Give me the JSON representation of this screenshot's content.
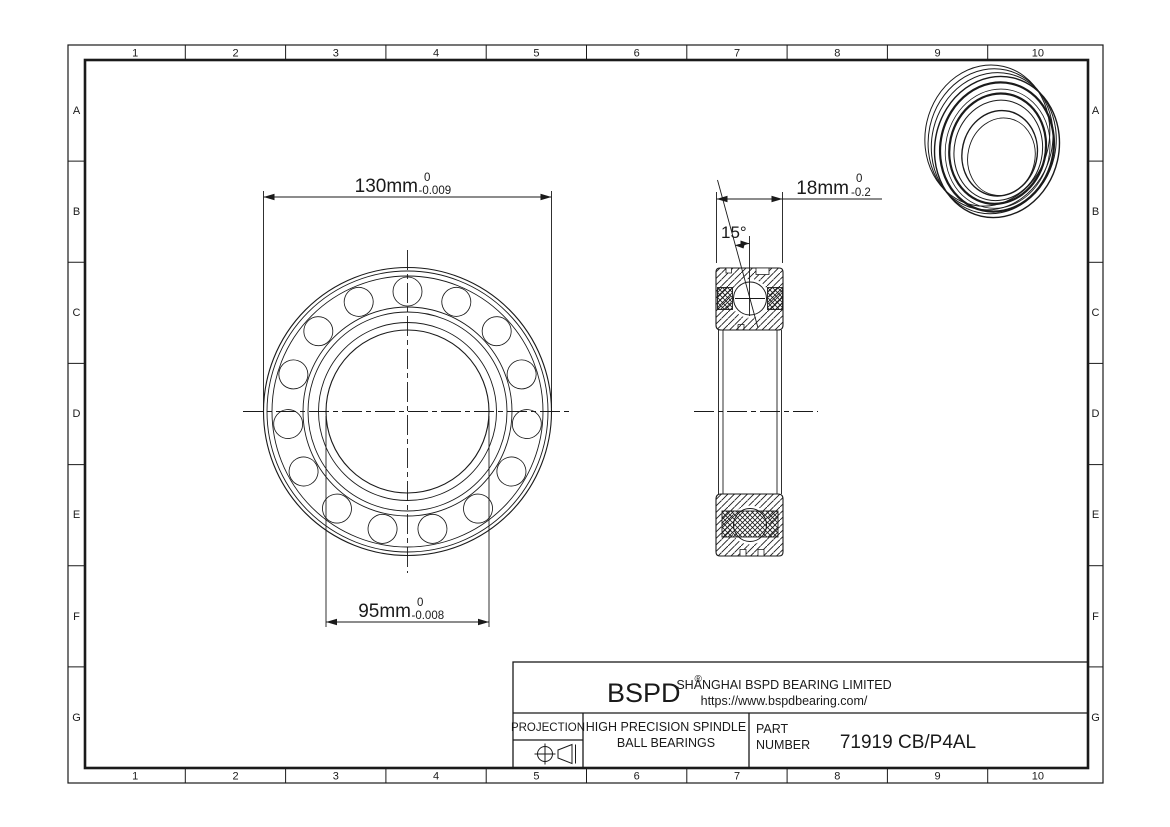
{
  "sheet": {
    "background": "#ffffff",
    "line_color": "#1a1a1a"
  },
  "rulers": {
    "columns": [
      "1",
      "2",
      "3",
      "4",
      "5",
      "6",
      "7",
      "8",
      "9",
      "10"
    ],
    "rows": [
      "A",
      "B",
      "C",
      "D",
      "E",
      "F",
      "G"
    ]
  },
  "dimensions": {
    "outer_diameter": {
      "value": "130mm",
      "tol_upper": "0",
      "tol_lower": "-0.009"
    },
    "bore_diameter": {
      "value": "95mm",
      "tol_upper": "0",
      "tol_lower": "-0.008"
    },
    "width": {
      "value": "18mm",
      "tol_upper": "0",
      "tol_lower": "-0.2"
    },
    "contact_angle": {
      "value": "15°"
    }
  },
  "title_block": {
    "logo": "BSPD",
    "registered": "®",
    "company": "SHANGHAI BSPD BEARING LIMITED",
    "website": "https://www.bspdbearing.com/",
    "projection_label": "PROJECTION",
    "product_line1": "HIGH  PRECISION SPINDLE",
    "product_line2": "BALL BEARINGS",
    "part_label1": "PART",
    "part_label2": "NUMBER",
    "part_number": "71919 CB/P4AL"
  }
}
